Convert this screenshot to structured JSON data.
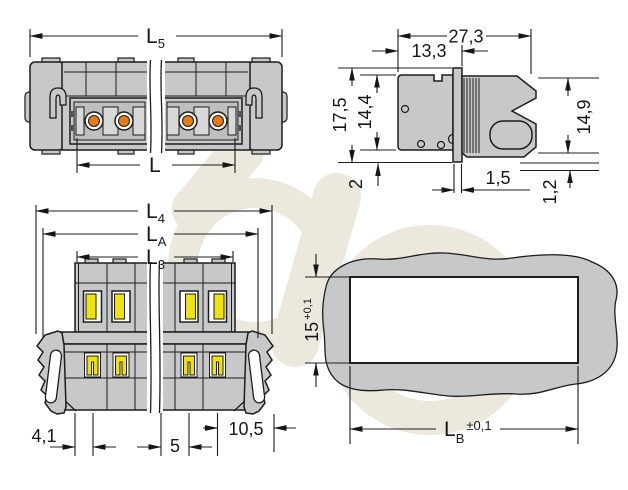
{
  "title": "connector-dimension-drawing",
  "views": {
    "top_view": {
      "l5_main": "L",
      "l5_sub": "5",
      "l_label": "L"
    },
    "side_view": {
      "depth_total": "27,3",
      "depth_front": "13,3",
      "height_total": "17,5",
      "height_body": "14,4",
      "height_plug": "14,9",
      "bottom_offset": "2",
      "flange_thickness": "1,5",
      "lip_height": "1,2"
    },
    "front_view": {
      "l4_main": "L",
      "l4_sub": "4",
      "la_main": "L",
      "la_sub": "A",
      "l3_main": "L",
      "l3_sub": "3",
      "edge_to_pole": "4,1",
      "pitch": "5",
      "pole_to_edge": "10,5"
    },
    "panel_cutout": {
      "height": "15",
      "height_tol": "+0,1",
      "width_main": "L",
      "width_sub": "B",
      "width_tol": "±0,1"
    }
  },
  "colors": {
    "body_gray": "#c7c8c9",
    "body_gray_light": "#d8d8d8",
    "body_gray_dark": "#bebfc0",
    "terminal_orange": "#ea7a12",
    "lever_yellow": "#f0e300",
    "line_black": "#1c1c1c",
    "watermark_beige": "#ece8dd",
    "cutout_white": "#ffffff"
  }
}
